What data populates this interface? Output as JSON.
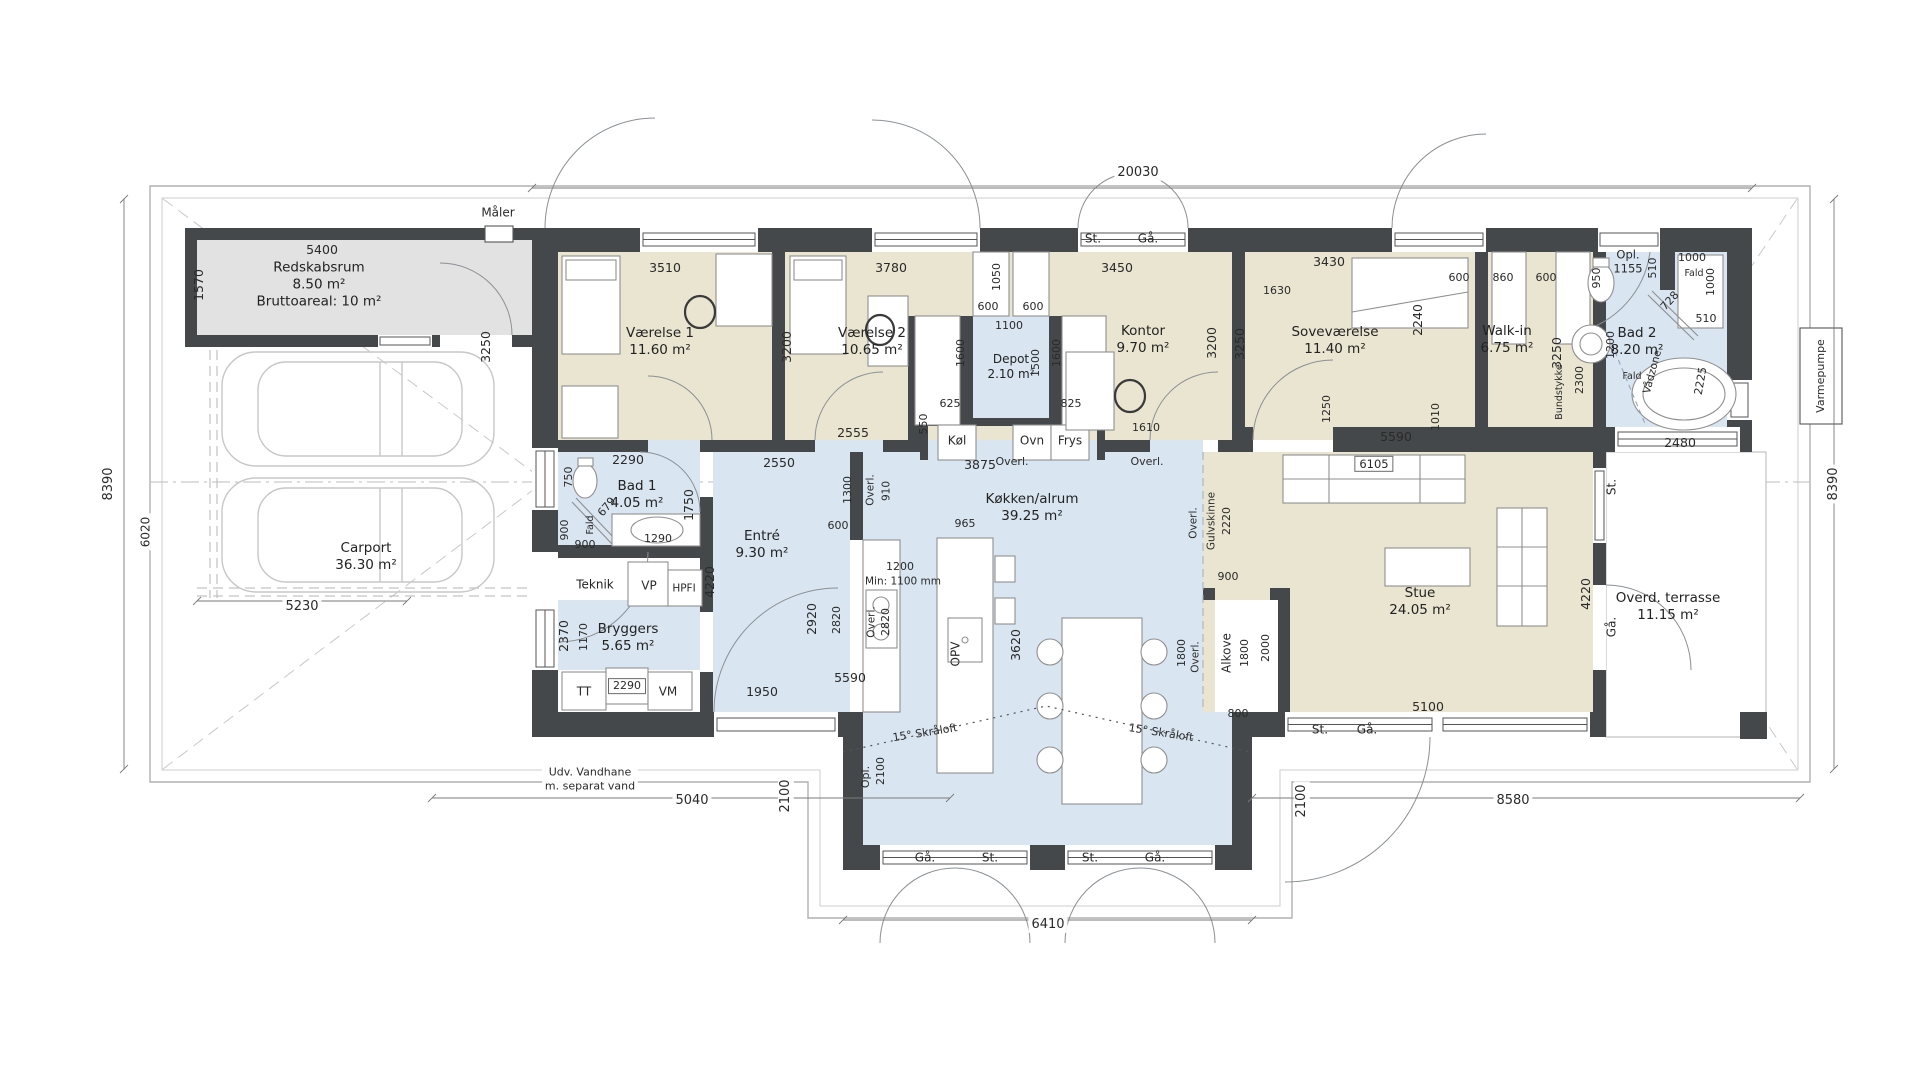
{
  "plan": {
    "type": "architectural-floor-plan",
    "colors": {
      "wall": "#45484b",
      "bedroom_floor": "#eae5d1",
      "wet_room_floor": "#d9e5f1",
      "shed_floor": "#e2e2e2",
      "dim_text": "#2a2a2a",
      "thin_line": "#8d9296"
    },
    "labels": [
      {
        "k": "r",
        "L": [
          "Redskabsrum",
          "8.50 m²",
          "Bruttoareal: 10 m²"
        ],
        "x": 319,
        "y": 285
      },
      {
        "k": "r",
        "L": [
          "Carport",
          "36.30 m²"
        ],
        "x": 366,
        "y": 557
      },
      {
        "k": "r",
        "L": [
          "Værelse 1",
          "11.60 m²"
        ],
        "x": 660,
        "y": 342
      },
      {
        "k": "r",
        "L": [
          "Værelse 2",
          "10.65 m²"
        ],
        "x": 872,
        "y": 342
      },
      {
        "k": "r",
        "L": [
          "Depot",
          "2.10 m²"
        ],
        "x": 1011,
        "y": 367,
        "fs": 12
      },
      {
        "k": "r",
        "L": [
          "Kontor",
          "9.70 m²"
        ],
        "x": 1143,
        "y": 340
      },
      {
        "k": "r",
        "L": [
          "Soveværelse",
          "11.40 m²"
        ],
        "x": 1335,
        "y": 341
      },
      {
        "k": "r",
        "L": [
          "Walk-in",
          "6.75 m²"
        ],
        "x": 1507,
        "y": 340
      },
      {
        "k": "r",
        "L": [
          "Bad 2",
          "8.20 m²"
        ],
        "x": 1637,
        "y": 342
      },
      {
        "k": "r",
        "L": [
          "Bad 1",
          "4.05 m²"
        ],
        "x": 637,
        "y": 495
      },
      {
        "k": "r",
        "L": [
          "Entré",
          "9.30 m²"
        ],
        "x": 762,
        "y": 545
      },
      {
        "k": "r",
        "L": [
          "Bryggers",
          "5.65 m²"
        ],
        "x": 628,
        "y": 638
      },
      {
        "k": "r",
        "L": [
          "Køkken/alrum",
          "39.25 m²"
        ],
        "x": 1032,
        "y": 508
      },
      {
        "k": "r",
        "L": [
          "Stue",
          "24.05 m²"
        ],
        "x": 1420,
        "y": 602
      },
      {
        "k": "r",
        "L": [
          "Overd. terrasse",
          "11.15 m²"
        ],
        "x": 1668,
        "y": 607
      },
      {
        "k": "r",
        "t": "Teknik",
        "x": 595,
        "y": 585,
        "fs": 12
      },
      {
        "k": "f",
        "t": "VP",
        "x": 649,
        "y": 586
      },
      {
        "k": "f",
        "t": "HPFI",
        "x": 684,
        "y": 589,
        "fs": 10.5
      },
      {
        "k": "f",
        "t": "TT",
        "x": 584,
        "y": 692
      },
      {
        "k": "f",
        "t": "VM",
        "x": 668,
        "y": 692
      },
      {
        "k": "f",
        "t": "Køl",
        "x": 957,
        "y": 441
      },
      {
        "k": "f",
        "t": "Ovn",
        "x": 1032,
        "y": 441
      },
      {
        "k": "f",
        "t": "Frys",
        "x": 1070,
        "y": 441
      },
      {
        "k": "f",
        "t": "OPV",
        "x": 956,
        "y": 654,
        "r": -90
      },
      {
        "k": "f",
        "t": "Alkove",
        "x": 1227,
        "y": 653,
        "r": -90
      },
      {
        "k": "s",
        "t": "20030",
        "x": 1138,
        "y": 173
      },
      {
        "k": "s",
        "t": "8390",
        "x": 109,
        "y": 484,
        "r": -90
      },
      {
        "k": "s",
        "t": "8390",
        "x": 1834,
        "y": 484,
        "r": -90
      },
      {
        "k": "s",
        "t": "6020",
        "x": 146,
        "y": 532,
        "r": -90,
        "fs": 12
      },
      {
        "k": "s",
        "t": "5230",
        "x": 302,
        "y": 607
      },
      {
        "k": "s",
        "t": "5040",
        "x": 692,
        "y": 801
      },
      {
        "k": "s",
        "t": "6410",
        "x": 1048,
        "y": 925
      },
      {
        "k": "s",
        "t": "8580",
        "x": 1513,
        "y": 801
      },
      {
        "k": "s",
        "t": "2100",
        "x": 786,
        "y": 796,
        "r": -90
      },
      {
        "k": "s",
        "t": "2100",
        "x": 1302,
        "y": 801,
        "r": -90
      },
      {
        "k": "s",
        "L": [
          "Udv. Vandhane",
          "m. separat vand"
        ],
        "x": 590,
        "y": 779,
        "fs": 11
      },
      {
        "k": "s",
        "t": "Varmepumpe",
        "x": 1821,
        "y": 376,
        "r": -90,
        "fs": 11
      },
      {
        "k": "s",
        "t": "Måler",
        "x": 498,
        "y": 213,
        "fs": 12
      },
      {
        "k": "w",
        "t": "St.",
        "x": 1093,
        "y": 239
      },
      {
        "k": "w",
        "t": "Gå.",
        "x": 1148,
        "y": 239
      },
      {
        "k": "w",
        "t": "Gå.",
        "x": 925,
        "y": 858
      },
      {
        "k": "w",
        "t": "St.",
        "x": 990,
        "y": 858
      },
      {
        "k": "w",
        "t": "St.",
        "x": 1090,
        "y": 858
      },
      {
        "k": "w",
        "t": "Gå.",
        "x": 1155,
        "y": 858
      },
      {
        "k": "w",
        "t": "St.",
        "x": 1320,
        "y": 730
      },
      {
        "k": "w",
        "t": "Gå.",
        "x": 1367,
        "y": 730
      },
      {
        "k": "w",
        "t": "St.",
        "x": 1612,
        "y": 487,
        "r": -90
      },
      {
        "k": "w",
        "t": "Gå.",
        "x": 1612,
        "y": 627,
        "r": -90
      },
      {
        "k": "d",
        "t": "5400",
        "x": 322,
        "y": 250
      },
      {
        "k": "d",
        "t": "1570",
        "x": 199,
        "y": 285,
        "r": -90
      },
      {
        "k": "d",
        "t": "3510",
        "x": 665,
        "y": 268
      },
      {
        "k": "d",
        "t": "3250",
        "x": 486,
        "y": 347,
        "r": -90
      },
      {
        "k": "d",
        "t": "3200",
        "x": 787,
        "y": 347,
        "r": -90
      },
      {
        "k": "d",
        "t": "3780",
        "x": 891,
        "y": 268
      },
      {
        "k": "d",
        "t": "2555",
        "x": 853,
        "y": 433
      },
      {
        "k": "d",
        "t": "1050",
        "x": 997,
        "y": 277,
        "r": -90,
        "fs": 11
      },
      {
        "k": "d",
        "t": "600",
        "x": 988,
        "y": 307,
        "fs": 11
      },
      {
        "k": "d",
        "t": "600",
        "x": 1033,
        "y": 307,
        "fs": 11
      },
      {
        "k": "d",
        "t": "1100",
        "x": 1009,
        "y": 326,
        "fs": 11
      },
      {
        "k": "d",
        "t": "1600",
        "x": 961,
        "y": 353,
        "r": -90,
        "fs": 11
      },
      {
        "k": "d",
        "t": "1500",
        "x": 1036,
        "y": 363,
        "r": -90,
        "fs": 11
      },
      {
        "k": "d",
        "t": "1600",
        "x": 1057,
        "y": 353,
        "r": -90,
        "fs": 11
      },
      {
        "k": "d",
        "t": "625",
        "x": 950,
        "y": 404,
        "fs": 11
      },
      {
        "k": "d",
        "t": "825",
        "x": 1071,
        "y": 404,
        "fs": 11
      },
      {
        "k": "d",
        "t": "550",
        "x": 924,
        "y": 424,
        "r": -90,
        "fs": 11
      },
      {
        "k": "d",
        "t": "3450",
        "x": 1117,
        "y": 268
      },
      {
        "k": "d",
        "t": "3200",
        "x": 1212,
        "y": 343,
        "r": -90
      },
      {
        "k": "d",
        "t": "3250",
        "x": 1240,
        "y": 344,
        "r": -90
      },
      {
        "k": "d",
        "t": "1610",
        "x": 1146,
        "y": 428,
        "fs": 11
      },
      {
        "k": "d",
        "t": "3430",
        "x": 1329,
        "y": 262
      },
      {
        "k": "d",
        "t": "1630",
        "x": 1277,
        "y": 291,
        "fs": 11
      },
      {
        "k": "d",
        "t": "2240",
        "x": 1418,
        "y": 320,
        "r": -90
      },
      {
        "k": "d",
        "t": "1250",
        "x": 1327,
        "y": 409,
        "r": -90,
        "fs": 11
      },
      {
        "k": "d",
        "t": "1010",
        "x": 1436,
        "y": 417,
        "r": -90,
        "fs": 11
      },
      {
        "k": "d",
        "t": "5590",
        "x": 1396,
        "y": 437
      },
      {
        "k": "d",
        "t": "600",
        "x": 1459,
        "y": 278,
        "fs": 11
      },
      {
        "k": "d",
        "t": "860",
        "x": 1503,
        "y": 278,
        "fs": 11
      },
      {
        "k": "d",
        "t": "600",
        "x": 1546,
        "y": 278,
        "fs": 11
      },
      {
        "k": "d",
        "t": "3250",
        "x": 1557,
        "y": 353,
        "r": -90
      },
      {
        "k": "d",
        "L": [
          "Opl.",
          "1155"
        ],
        "x": 1628,
        "y": 262,
        "fs": 11.5
      },
      {
        "k": "d",
        "t": "950",
        "x": 1597,
        "y": 278,
        "r": -90,
        "fs": 11
      },
      {
        "k": "d",
        "t": "510",
        "x": 1653,
        "y": 268,
        "r": -90,
        "fs": 11
      },
      {
        "k": "d",
        "t": "1000",
        "x": 1692,
        "y": 258,
        "fs": 11
      },
      {
        "k": "d",
        "t": "Fald",
        "x": 1694,
        "y": 274,
        "fs": 9.5
      },
      {
        "k": "d",
        "t": "1000",
        "x": 1711,
        "y": 282,
        "r": -90,
        "fs": 11
      },
      {
        "k": "d",
        "t": "728",
        "x": 1670,
        "y": 301,
        "r": -48,
        "fs": 11
      },
      {
        "k": "d",
        "t": "510",
        "x": 1706,
        "y": 319,
        "fs": 11
      },
      {
        "k": "d",
        "t": "1200",
        "x": 1611,
        "y": 345,
        "r": -90,
        "fs": 11
      },
      {
        "k": "d",
        "t": "2300",
        "x": 1580,
        "y": 380,
        "r": -90,
        "fs": 11
      },
      {
        "k": "d",
        "t": "Bundstykke",
        "x": 1560,
        "y": 392,
        "r": -90,
        "fs": 9.5
      },
      {
        "k": "d",
        "t": "Vådzone",
        "x": 1653,
        "y": 372,
        "r": -75,
        "fs": 10.5
      },
      {
        "k": "d",
        "t": "2225",
        "x": 1701,
        "y": 381,
        "r": -80,
        "fs": 11
      },
      {
        "k": "d",
        "t": "Fald",
        "x": 1632,
        "y": 377,
        "fs": 9.5
      },
      {
        "k": "d",
        "t": "2480",
        "x": 1680,
        "y": 443
      },
      {
        "k": "d",
        "t": "2290",
        "x": 628,
        "y": 460
      },
      {
        "k": "d",
        "t": "750",
        "x": 569,
        "y": 477,
        "r": -90,
        "fs": 11
      },
      {
        "k": "d",
        "t": "679",
        "x": 607,
        "y": 507,
        "r": -50,
        "fs": 11
      },
      {
        "k": "d",
        "t": "1750",
        "x": 689,
        "y": 505,
        "r": -90
      },
      {
        "k": "d",
        "t": "900",
        "x": 565,
        "y": 530,
        "r": -90,
        "fs": 11
      },
      {
        "k": "d",
        "t": "Fald",
        "x": 591,
        "y": 525,
        "r": -90,
        "fs": 9.5
      },
      {
        "k": "d",
        "t": "900",
        "x": 585,
        "y": 545,
        "fs": 11
      },
      {
        "k": "d",
        "t": "1290",
        "x": 658,
        "y": 539,
        "fs": 11
      },
      {
        "k": "d",
        "t": "2370",
        "x": 564,
        "y": 636,
        "r": -90
      },
      {
        "k": "d",
        "t": "1170",
        "x": 584,
        "y": 637,
        "r": -90,
        "fs": 11
      },
      {
        "k": "d",
        "t": "2290",
        "x": 627,
        "y": 686,
        "b": 1,
        "fs": 11
      },
      {
        "k": "d",
        "t": "2550",
        "x": 779,
        "y": 463
      },
      {
        "k": "d",
        "t": "4220",
        "x": 710,
        "y": 582,
        "r": -90
      },
      {
        "k": "d",
        "t": "1300",
        "x": 848,
        "y": 490,
        "r": -90,
        "fs": 11
      },
      {
        "k": "d",
        "t": "Overl.",
        "x": 871,
        "y": 490,
        "r": -90,
        "fs": 10.5
      },
      {
        "k": "d",
        "t": "910",
        "x": 887,
        "y": 491,
        "r": -90,
        "fs": 10.5
      },
      {
        "k": "d",
        "t": "600",
        "x": 838,
        "y": 526,
        "fs": 11
      },
      {
        "k": "d",
        "t": "3875",
        "x": 980,
        "y": 465
      },
      {
        "k": "d",
        "t": "Overl.",
        "x": 1012,
        "y": 462,
        "fs": 11
      },
      {
        "k": "d",
        "t": "Overl.",
        "x": 1147,
        "y": 462,
        "fs": 11
      },
      {
        "k": "d",
        "t": "965",
        "x": 965,
        "y": 524,
        "fs": 11
      },
      {
        "k": "d",
        "t": "1200",
        "x": 900,
        "y": 567,
        "fs": 11
      },
      {
        "k": "d",
        "t": "Min: 1100 mm",
        "x": 903,
        "y": 582,
        "fs": 10.5
      },
      {
        "k": "d",
        "t": "2920",
        "x": 812,
        "y": 619,
        "r": -90
      },
      {
        "k": "d",
        "t": "2820",
        "x": 837,
        "y": 620,
        "r": -90,
        "fs": 11
      },
      {
        "k": "d",
        "t": "Overl.",
        "x": 872,
        "y": 622,
        "r": -90,
        "fs": 10.5
      },
      {
        "k": "d",
        "t": "2820",
        "x": 886,
        "y": 622,
        "r": -90,
        "fs": 11
      },
      {
        "k": "d",
        "t": "3620",
        "x": 1016,
        "y": 645,
        "r": -90
      },
      {
        "k": "d",
        "t": "1950",
        "x": 762,
        "y": 692
      },
      {
        "k": "d",
        "t": "15° Skråloft",
        "x": 925,
        "y": 733,
        "r": -9,
        "fs": 11
      },
      {
        "k": "d",
        "t": "15° Skråloft",
        "x": 1161,
        "y": 733,
        "r": 9,
        "fs": 11
      },
      {
        "k": "d",
        "t": "Opl.",
        "x": 866,
        "y": 777,
        "r": -90,
        "fs": 11
      },
      {
        "k": "d",
        "t": "2100",
        "x": 881,
        "y": 771,
        "r": -90,
        "fs": 11
      },
      {
        "k": "d",
        "t": "5590",
        "x": 850,
        "y": 678
      },
      {
        "k": "d",
        "t": "6105",
        "x": 1374,
        "y": 464,
        "b": 1,
        "fs": 11.5
      },
      {
        "k": "d",
        "t": "Gulvskinne",
        "x": 1212,
        "y": 521,
        "r": -90,
        "fs": 10.5
      },
      {
        "k": "d",
        "t": "2220",
        "x": 1227,
        "y": 521,
        "r": -90,
        "fs": 11
      },
      {
        "k": "d",
        "t": "Overl.",
        "x": 1194,
        "y": 523,
        "r": -90,
        "fs": 10.5
      },
      {
        "k": "d",
        "t": "900",
        "x": 1228,
        "y": 577,
        "fs": 11
      },
      {
        "k": "d",
        "t": "1800",
        "x": 1182,
        "y": 653,
        "r": -90,
        "fs": 11
      },
      {
        "k": "d",
        "t": "Overl.",
        "x": 1196,
        "y": 657,
        "r": -90,
        "fs": 10.5
      },
      {
        "k": "d",
        "t": "1800",
        "x": 1245,
        "y": 653,
        "r": -90,
        "fs": 11
      },
      {
        "k": "d",
        "t": "2000",
        "x": 1266,
        "y": 648,
        "r": -90,
        "fs": 11
      },
      {
        "k": "d",
        "t": "800",
        "x": 1238,
        "y": 714,
        "fs": 11
      },
      {
        "k": "d",
        "t": "5100",
        "x": 1428,
        "y": 707
      },
      {
        "k": "d",
        "t": "4220",
        "x": 1586,
        "y": 594,
        "r": -90
      }
    ]
  }
}
